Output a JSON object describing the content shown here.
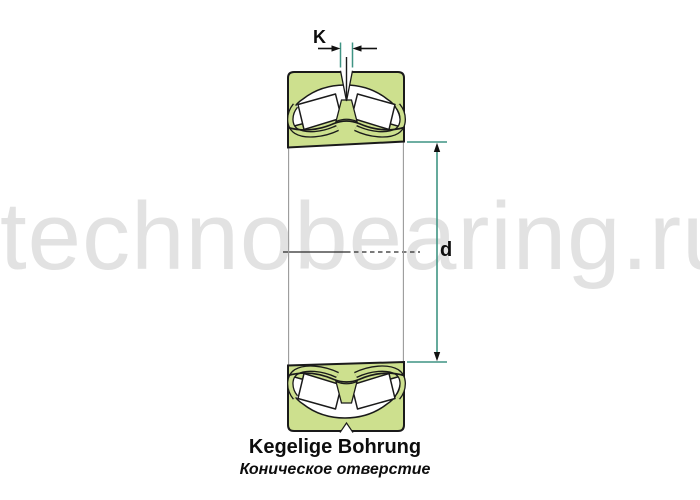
{
  "watermark": {
    "text": "technobearing.ru"
  },
  "dimensions": {
    "groove_width_label": "K",
    "bore_diameter_label": "d"
  },
  "caption": {
    "german": "Kegelige Bohrung",
    "russian": "Коническое отверстие"
  },
  "colors": {
    "bearing_fill": "#cde08e",
    "outline": "#1a1a1a",
    "dimension_line": "#3f9484",
    "extension_gray": "#9a9a9a",
    "watermark": "#e2e2e2",
    "text": "#0d0d0d"
  }
}
